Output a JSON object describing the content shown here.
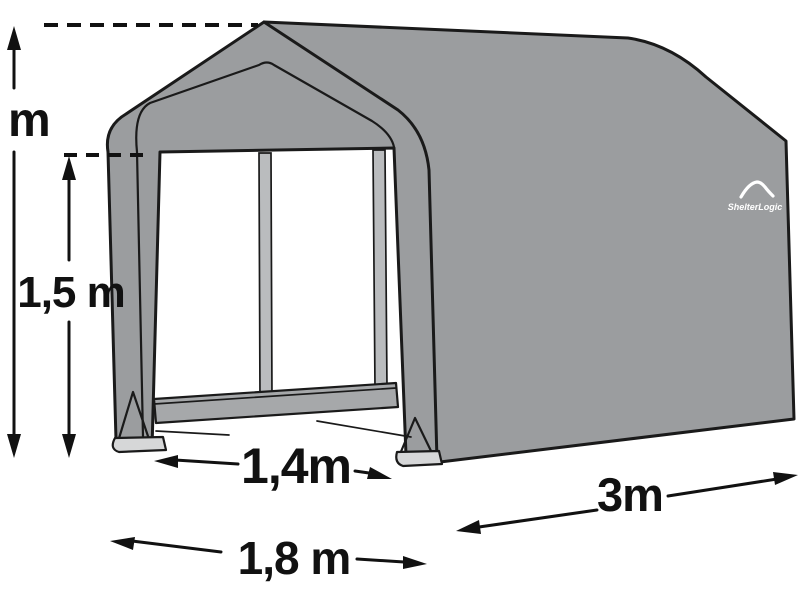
{
  "diagram_title": "Storage shelter dimension diagram",
  "brand": {
    "logo_text": "ShelterLogic"
  },
  "dimensions": {
    "peak_height": {
      "label": "m",
      "measures": "total height to roof peak (number cropped at image edge)"
    },
    "eave_height": {
      "label": "1,5 m",
      "measures": "door / eave height"
    },
    "door_width": {
      "label": "1,4m",
      "measures": "door opening width"
    },
    "base_width": {
      "label": "1,8 m",
      "measures": "overall front width"
    },
    "depth": {
      "label": "3m",
      "measures": "overall depth"
    }
  },
  "colors": {
    "fabric": "#9b9d9f",
    "pole": "#babcbe",
    "rail": "#a6a8aa",
    "foot_plate": "#d6d7d8",
    "outline": "#1a1a1a",
    "label_text": "#111111",
    "logo": "#ffffff",
    "background": "#ffffff"
  }
}
